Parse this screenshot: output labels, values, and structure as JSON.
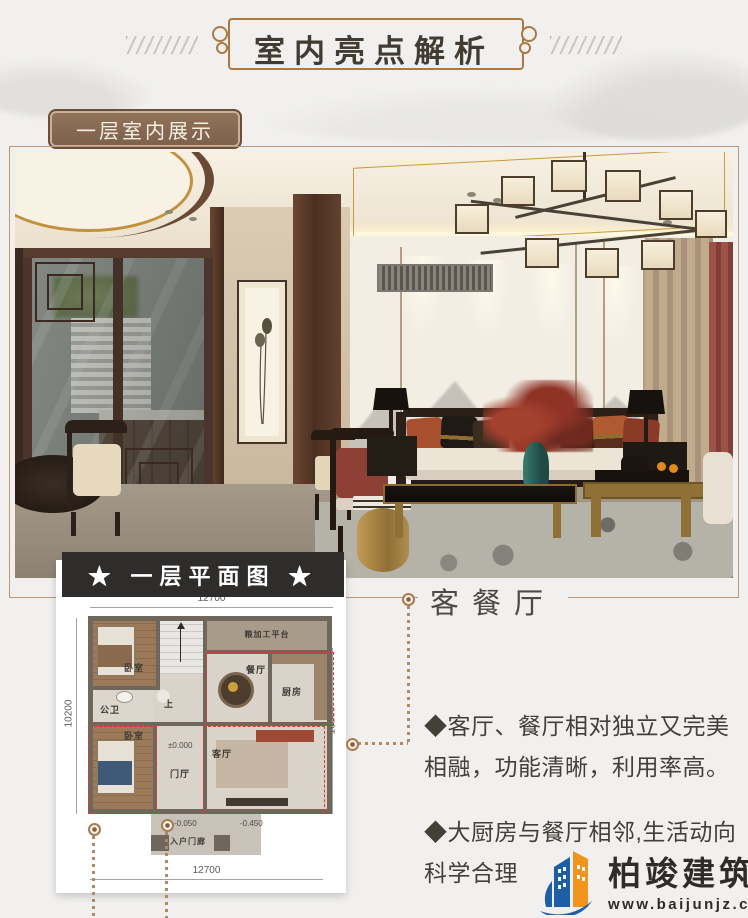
{
  "palette": {
    "page_bg": "#f1f0ee",
    "ornament_brown": "#aa7a42",
    "badge_brown": "#8a6951",
    "banner_black": "#2e2d2b",
    "photo_frame_line": "#bb9877",
    "leader_brown": "#b08a62",
    "highlight_red_dash": "#e0392c",
    "logo_blue": "#1d5fa6",
    "logo_orange": "#f0941d"
  },
  "header": {
    "title": "室内亮点解析"
  },
  "badge": {
    "label": "一层室内展示"
  },
  "plan_banner": {
    "label": "★ 一层平面图 ★"
  },
  "floor_plan": {
    "dims": {
      "top": "12700",
      "bottom": "12700",
      "left": "10200",
      "right": "10800"
    },
    "rooms": {
      "bedroom_top": "卧室",
      "bedroom_bottom": "卧室",
      "bath": "公卫",
      "dining": "餐厅",
      "kitchen": "厨房",
      "foyer": "门厅",
      "living": "客厅",
      "stairs": "上",
      "platform": "粮加工平台",
      "porch": "入户门廊"
    },
    "elevations": {
      "foyer": "±0.000",
      "porch": "-0.050",
      "ground": "-0.450"
    }
  },
  "callout": {
    "title": "客餐厅",
    "bullets": [
      "◆客厅、餐厅相对独立又完美相融，功能清晰，利用率高。",
      "◆大厨房与餐厅相邻,生活动向科学合理"
    ]
  },
  "logo": {
    "company": "柏竣建筑",
    "website": "www.baijunjz.com"
  }
}
